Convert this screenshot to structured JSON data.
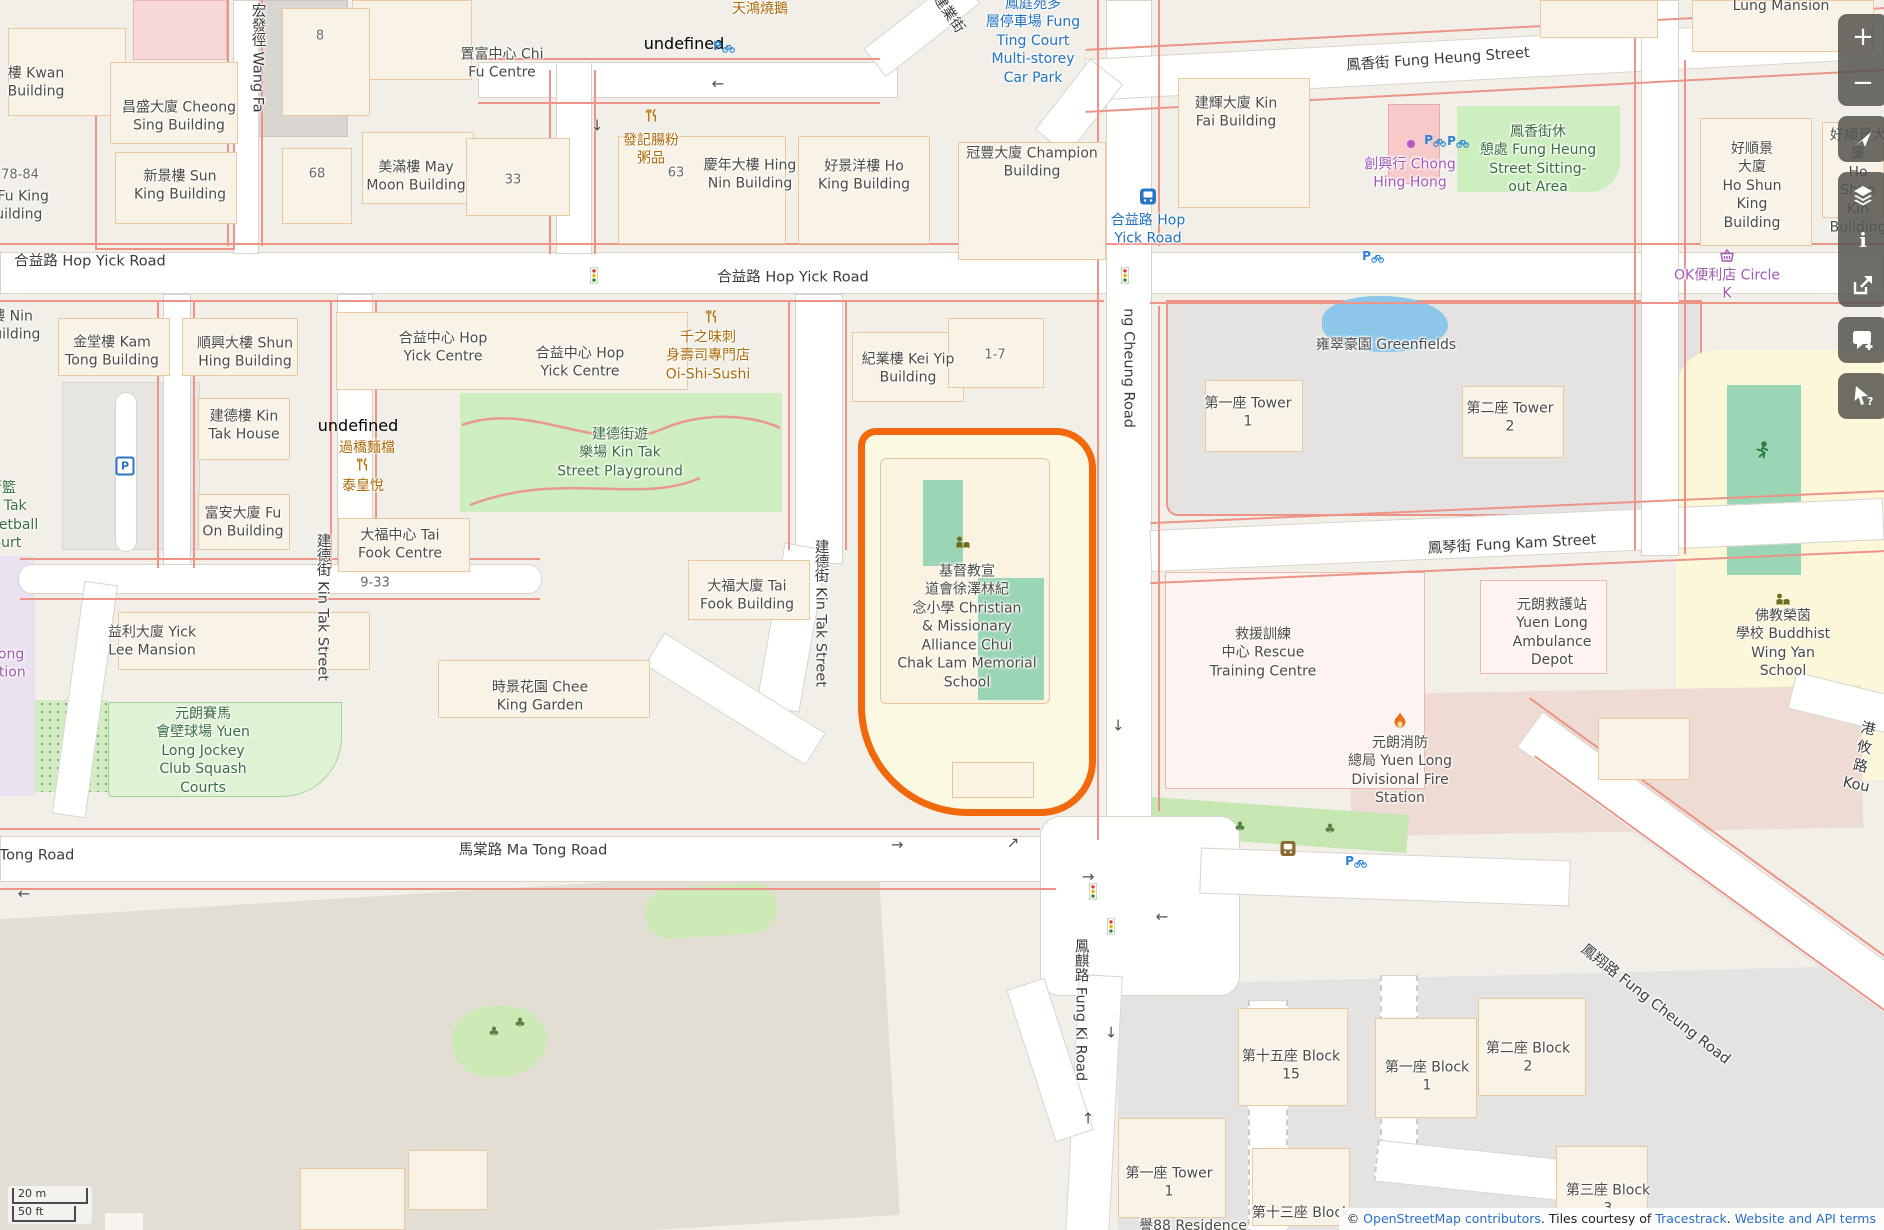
{
  "palette": {
    "land": "#f2efe9",
    "road": "#ffffff",
    "red_line": "#ec9488",
    "building": "#f9f2e6",
    "building_outline": "#eac9a0",
    "park_green": "#cfeec0",
    "pitch_teal": "#9ad5b5",
    "school_yellow": "#fcf9e3",
    "highlight_orange": "#f2690d",
    "water_blue": "#8cc7ea",
    "estate_gray": "#e4e3e1",
    "fire_pink": "#eedbd3",
    "lavender": "#eae1f0",
    "toolbar_bg": "#56544e",
    "label_blue": "#2273c3",
    "label_purple": "#a259b5",
    "label_orange": "#ad6b07",
    "label_green": "#39703c"
  },
  "labels": [
    {
      "n": "road-hop-yick-left",
      "t": "合益路 Hop Yick Road",
      "x": 90,
      "y": 262,
      "c": "st"
    },
    {
      "n": "road-hop-yick-center",
      "t": "合益路 Hop Yick Road",
      "x": 793,
      "y": 278,
      "c": "st"
    },
    {
      "n": "road-fung-heung-street",
      "t": "鳳香街 Fung Heung Street",
      "x": 1438,
      "y": 60,
      "c": "st",
      "r": -4
    },
    {
      "n": "road-fung-kam-street",
      "t": "鳳琴街 Fung Kam Street",
      "x": 1512,
      "y": 545,
      "c": "st",
      "r": -3
    },
    {
      "n": "road-ma-tong",
      "t": "馬棠路 Ma Tong Road",
      "x": 533,
      "y": 851,
      "c": "st"
    },
    {
      "n": "road-ma-tong-left",
      "t": "Ma Tong Road",
      "x": 24,
      "y": 856,
      "c": "st"
    },
    {
      "n": "road-wang-fat-path",
      "t": "宏發徑 Wang Fa",
      "x": 257,
      "y": 58,
      "c": "st",
      "v": 1
    },
    {
      "n": "road-kin-tak-street-w",
      "t": "建德街 Kin Tak Street",
      "x": 322,
      "y": 607,
      "c": "st",
      "v": 1
    },
    {
      "n": "road-kin-tak-street-e",
      "t": "建德街 Kin Tak Street",
      "x": 820,
      "y": 613,
      "c": "st",
      "v": 1
    },
    {
      "n": "road-fung-cheung",
      "t": "ng Cheung Road",
      "x": 1128,
      "y": 368,
      "c": "st",
      "v": 1
    },
    {
      "n": "road-fung-ki",
      "t": "鳳麒路 Fung Ki Road",
      "x": 1080,
      "y": 1010,
      "c": "st",
      "v": 1
    },
    {
      "n": "road-fung-cheung-se",
      "t": "鳳翔路 Fung Cheung Road",
      "x": 1655,
      "y": 1005,
      "c": "st",
      "r": 38
    },
    {
      "n": "road-kong-yau",
      "t": "港攸路 Kou",
      "x": 1862,
      "y": 758,
      "c": "st",
      "r": 12
    },
    {
      "n": "road-kin-yip-street",
      "t": "建業街",
      "x": 948,
      "y": 14,
      "c": "st",
      "r": 55
    },
    {
      "n": "carpark-fung-ting",
      "t": "鳳庭苑多\n層停車場 Fung\nTing Court\nMulti-storey\nCar Park",
      "x": 1033,
      "y": 41,
      "c": "blu"
    },
    {
      "n": "busstop-hop-yick",
      "t": "合益路 Hop\nYick Road",
      "x": 1148,
      "y": 230,
      "c": "blu"
    },
    {
      "n": "bld-kwan",
      "t": "樓 Kwan\nBuilding",
      "x": 36,
      "y": 83,
      "c": ""
    },
    {
      "n": "bld-cheong-sing",
      "t": "昌盛大廈 Cheong\nSing Building",
      "x": 179,
      "y": 117,
      "c": ""
    },
    {
      "n": "bld-sun-king",
      "t": "新景樓 Sun\nKing Building",
      "x": 180,
      "y": 186,
      "c": ""
    },
    {
      "n": "num-78-84",
      "t": "78-84",
      "x": 20,
      "y": 175,
      "c": "num"
    },
    {
      "n": "bld-fu-king",
      "t": "樓 Fu King\nBuilding",
      "x": 14,
      "y": 206,
      "c": ""
    },
    {
      "n": "num-8",
      "t": "8",
      "x": 320,
      "y": 36,
      "c": "num"
    },
    {
      "n": "num-68",
      "t": "68",
      "x": 317,
      "y": 174,
      "c": "num"
    },
    {
      "n": "bld-may-moon",
      "t": "美滿樓 May\nMoon Building",
      "x": 416,
      "y": 177,
      "c": ""
    },
    {
      "n": "bld-chi-fu",
      "t": "置富中心 Chi\nFu Centre",
      "x": 502,
      "y": 64,
      "c": ""
    },
    {
      "n": "num-33",
      "t": "33",
      "x": 513,
      "y": 180,
      "c": "num"
    },
    {
      "n": "num-63",
      "t": "63",
      "x": 676,
      "y": 173,
      "c": "num"
    },
    {
      "n": "bld-hing-nin",
      "t": "慶年大樓 Hing\nNin Building",
      "x": 750,
      "y": 175,
      "c": ""
    },
    {
      "n": "bld-ho-king",
      "t": "好景洋樓 Ho\nKing Building",
      "x": 864,
      "y": 176,
      "c": ""
    },
    {
      "n": "bld-champion",
      "t": "冠豐大廈 Champion\nBuilding",
      "x": 1032,
      "y": 163,
      "c": ""
    },
    {
      "n": "bld-kin-fai",
      "t": "建輝大廈 Kin\nFai Building",
      "x": 1236,
      "y": 113,
      "c": ""
    },
    {
      "n": "bld-lung-mansion",
      "t": "Lung Mansion",
      "x": 1781,
      "y": 6,
      "c": ""
    },
    {
      "n": "bld-ho-shun-king",
      "t": "好順景\n大廈\nHo Shun\nKing\nBuilding",
      "x": 1752,
      "y": 186,
      "c": ""
    },
    {
      "n": "bld-ho-shun-kin",
      "t": "好順景大廈\nHo Shun Kin\nBuilding",
      "x": 1858,
      "y": 182,
      "c": ""
    },
    {
      "n": "bld-kei-yip",
      "t": "紀業樓 Kei Yip\nBuilding",
      "x": 908,
      "y": 369,
      "c": ""
    },
    {
      "n": "num-1-7",
      "t": "1-7",
      "x": 995,
      "y": 355,
      "c": "num"
    },
    {
      "n": "bld-greenfields",
      "t": "雍翠豪園 Greenfields",
      "x": 1386,
      "y": 345,
      "c": ""
    },
    {
      "n": "bld-tower-1",
      "t": "第一座 Tower\n1",
      "x": 1248,
      "y": 413,
      "c": ""
    },
    {
      "n": "bld-tower-2",
      "t": "第二座 Tower\n2",
      "x": 1510,
      "y": 418,
      "c": ""
    },
    {
      "n": "bld-kam-tong",
      "t": "金堂樓 Kam\nTong Building",
      "x": 112,
      "y": 352,
      "c": ""
    },
    {
      "n": "bld-shun-hing",
      "t": "順興大樓 Shun\nHing Building",
      "x": 245,
      "y": 353,
      "c": ""
    },
    {
      "n": "bld-nin",
      "t": "樓 Nin\nBuilding",
      "x": 12,
      "y": 326,
      "c": ""
    },
    {
      "n": "bld-kin-tak-house",
      "t": "建德樓 Kin\nTak House",
      "x": 244,
      "y": 426,
      "c": ""
    },
    {
      "n": "bld-fu-on",
      "t": "富安大廈 Fu\nOn Building",
      "x": 243,
      "y": 523,
      "c": ""
    },
    {
      "n": "bld-hop-yick-centre-1",
      "t": "合益中心 Hop\nYick Centre",
      "x": 443,
      "y": 348,
      "c": ""
    },
    {
      "n": "bld-hop-yick-centre-2",
      "t": "合益中心 Hop\nYick Centre",
      "x": 580,
      "y": 363,
      "c": ""
    },
    {
      "n": "bld-tai-fook-centre",
      "t": "大福中心 Tai\nFook Centre",
      "x": 400,
      "y": 545,
      "c": ""
    },
    {
      "n": "num-9-33",
      "t": "9-33",
      "x": 375,
      "y": 583,
      "c": "num"
    },
    {
      "n": "bld-yick-lee",
      "t": "益利大廈 Yick\nLee Mansion",
      "x": 152,
      "y": 642,
      "c": ""
    },
    {
      "n": "bld-chee-king",
      "t": "時景花園 Chee\nKing Garden",
      "x": 540,
      "y": 697,
      "c": ""
    },
    {
      "n": "bld-tai-fook",
      "t": "大福大廈 Tai\nFook Building",
      "x": 747,
      "y": 596,
      "c": ""
    },
    {
      "n": "poi-school-main",
      "t": "基督教宣\n道會徐澤林紀\n念小學 Christian\n& Missionary\nAlliance Chui\nChak Lam Memorial\nSchool",
      "x": 967,
      "y": 627,
      "c": ""
    },
    {
      "n": "poi-rescue-centre",
      "t": "救援訓練\n中心 Rescue\nTraining Centre",
      "x": 1263,
      "y": 653,
      "c": ""
    },
    {
      "n": "poi-ambulance-depot",
      "t": "元朗救護站\nYuen Long\nAmbulance\nDepot",
      "x": 1552,
      "y": 633,
      "c": ""
    },
    {
      "n": "poi-fire-station",
      "t": "元朗消防\n總局 Yuen Long\nDivisional Fire\nStation",
      "x": 1400,
      "y": 771,
      "c": ""
    },
    {
      "n": "poi-buddhist-school",
      "t": "佛教榮茵\n學校 Buddhist\nWing Yan School",
      "x": 1783,
      "y": 644,
      "c": ""
    },
    {
      "n": "park-kin-tak-playground",
      "t": "建德街遊\n樂場 Kin Tak\nStreet Playground",
      "x": 620,
      "y": 453,
      "c": "grn"
    },
    {
      "n": "park-sitting-out",
      "t": "鳳香街休\n憩處 Fung Heung\nStreet Sitting-\nout Area",
      "x": 1538,
      "y": 160,
      "c": "grn"
    },
    {
      "n": "park-squash-courts",
      "t": "元朗賽馬\n會壁球場 Yuen\nLong Jockey\nClub Squash\nCourts",
      "x": 203,
      "y": 751,
      "c": "grn"
    },
    {
      "n": "park-basketball",
      "t": "街籃\nKin Tak\nBasketball\nCourt",
      "x": 2,
      "y": 516,
      "c": "grn"
    },
    {
      "n": "poi-tin-hung",
      "t": "天鴻燒鵝",
      "x": 760,
      "y": 9,
      "c": "org"
    },
    {
      "n": "poi-fat-kee",
      "t": "發記腸粉\n粥品",
      "x": 651,
      "y": 150,
      "c": "org"
    },
    {
      "n": "poi-oi-shi-sushi",
      "t": "千之味刺\n身壽司專門店\nOi-Shi-Sushi",
      "x": 708,
      "y": 356,
      "c": "org"
    },
    {
      "n": "poi-noodle-stall",
      "t": "過橋麵檔",
      "x": 367,
      "y": 448,
      "c": "org"
    },
    {
      "n": "poi-thai-wong",
      "t": "泰皇悅",
      "x": 363,
      "y": 486,
      "c": "org"
    },
    {
      "n": "poi-chong-hing-hong",
      "t": "創興行 Chong\nHing Hong",
      "x": 1410,
      "y": 174,
      "c": "pur"
    },
    {
      "n": "poi-circle-k",
      "t": "OK便利店 Circle\nK",
      "x": 1727,
      "y": 285,
      "c": "pur"
    },
    {
      "n": "poi-station-fragment",
      "t": "Tong\nation",
      "x": 8,
      "y": 664,
      "c": "pur"
    },
    {
      "n": "bld-block-15",
      "t": "第十五座 Block\n15",
      "x": 1291,
      "y": 1066,
      "c": ""
    },
    {
      "n": "bld-block-1",
      "t": "第一座 Block\n1",
      "x": 1427,
      "y": 1077,
      "c": ""
    },
    {
      "n": "bld-block-2",
      "t": "第二座 Block\n2",
      "x": 1528,
      "y": 1058,
      "c": ""
    },
    {
      "n": "bld-tower-1-s",
      "t": "第一座 Tower\n1",
      "x": 1169,
      "y": 1183,
      "c": ""
    },
    {
      "n": "bld-yu88",
      "t": "譽88 Residence",
      "x": 1193,
      "y": 1226,
      "c": ""
    },
    {
      "n": "bld-block-13",
      "t": "第十三座 Block",
      "x": 1301,
      "y": 1213,
      "c": ""
    },
    {
      "n": "bld-block-3",
      "t": "第三座 Block\n3",
      "x": 1608,
      "y": 1200,
      "c": ""
    }
  ],
  "icons": [
    {
      "n": "restaurant-icon",
      "k": "rest2",
      "x": 684,
      "y": 44
    },
    {
      "n": "restaurant-icon",
      "k": "rest",
      "x": 652,
      "y": 117
    },
    {
      "n": "restaurant-icon",
      "k": "rest",
      "x": 712,
      "y": 318
    },
    {
      "n": "restaurant-icon",
      "k": "rest2",
      "x": 358,
      "y": 426
    },
    {
      "n": "restaurant-icon",
      "k": "rest",
      "x": 363,
      "y": 466
    },
    {
      "n": "bicycle-parking-icon",
      "k": "bike",
      "x": 724,
      "y": 48
    },
    {
      "n": "bicycle-parking-icon",
      "k": "bike",
      "x": 1435,
      "y": 142
    },
    {
      "n": "bicycle-parking-icon",
      "k": "bike",
      "x": 1458,
      "y": 143
    },
    {
      "n": "bicycle-parking-icon",
      "k": "bike",
      "x": 1373,
      "y": 258
    },
    {
      "n": "bicycle-parking-icon",
      "k": "bike",
      "x": 1356,
      "y": 863
    },
    {
      "n": "parking-icon",
      "k": "pwhite",
      "x": 125,
      "y": 466
    },
    {
      "n": "bus-stop-icon",
      "k": "busblue",
      "x": 1148,
      "y": 198
    },
    {
      "n": "bus-stop-icon",
      "k": "busbrown",
      "x": 1288,
      "y": 850
    },
    {
      "n": "traffic-signal-icon",
      "k": "tl",
      "x": 594,
      "y": 277
    },
    {
      "n": "traffic-signal-icon",
      "k": "tl",
      "x": 1125,
      "y": 277
    },
    {
      "n": "traffic-signal-icon",
      "k": "tl",
      "x": 1093,
      "y": 893
    },
    {
      "n": "traffic-signal-icon",
      "k": "tl",
      "x": 1111,
      "y": 928
    },
    {
      "n": "school-icon",
      "k": "school",
      "x": 963,
      "y": 544
    },
    {
      "n": "school-icon",
      "k": "school",
      "x": 1783,
      "y": 601
    },
    {
      "n": "sports-pitch-icon",
      "k": "runner",
      "x": 1762,
      "y": 452
    },
    {
      "n": "fire-station-icon",
      "k": "flame",
      "x": 1400,
      "y": 722
    },
    {
      "n": "convenience-store-icon",
      "k": "basket",
      "x": 1727,
      "y": 257
    },
    {
      "n": "shop-dot-icon",
      "k": "dot",
      "x": 1411,
      "y": 143
    },
    {
      "n": "tree-icon",
      "k": "tree",
      "x": 494,
      "y": 1031
    },
    {
      "n": "tree-icon",
      "k": "tree",
      "x": 520,
      "y": 1022
    },
    {
      "n": "tree-icon",
      "k": "tree",
      "x": 1240,
      "y": 826
    },
    {
      "n": "tree-icon",
      "k": "tree",
      "x": 1330,
      "y": 828
    },
    {
      "n": "oneway-arrow-icon",
      "k": "ar",
      "t": "←",
      "x": 718,
      "y": 84
    },
    {
      "n": "oneway-arrow-icon",
      "k": "ar",
      "t": "↓",
      "x": 597,
      "y": 126
    },
    {
      "n": "oneway-arrow-icon",
      "k": "ar",
      "t": "←",
      "x": 24,
      "y": 894
    },
    {
      "n": "oneway-arrow-icon",
      "k": "ar",
      "t": "→",
      "x": 897,
      "y": 845
    },
    {
      "n": "oneway-arrow-icon",
      "k": "ar",
      "t": "↗",
      "x": 1013,
      "y": 843
    },
    {
      "n": "oneway-arrow-icon",
      "k": "ar",
      "t": "→",
      "x": 1088,
      "y": 877
    },
    {
      "n": "oneway-arrow-icon",
      "k": "ar",
      "t": "←",
      "x": 1162,
      "y": 917
    },
    {
      "n": "oneway-arrow-icon",
      "k": "ar",
      "t": "↓",
      "x": 1118,
      "y": 726
    },
    {
      "n": "oneway-arrow-icon",
      "k": "ar",
      "t": "↓",
      "x": 1111,
      "y": 1033
    },
    {
      "n": "oneway-arrow-icon",
      "k": "ar",
      "t": "↑",
      "x": 1088,
      "y": 1119
    }
  ],
  "toolbar": {
    "zoom_in": "+",
    "zoom_out": "−"
  },
  "scalebar": {
    "metric": "20 m",
    "imperial": "50 ft"
  },
  "attribution": {
    "prefix": "© ",
    "link_osm": "OpenStreetMap contributors",
    "mid1": ". Tiles courtesy of ",
    "link_tiles": "Tracestrack",
    "mid2": ". ",
    "link_terms": "Website and API terms"
  }
}
